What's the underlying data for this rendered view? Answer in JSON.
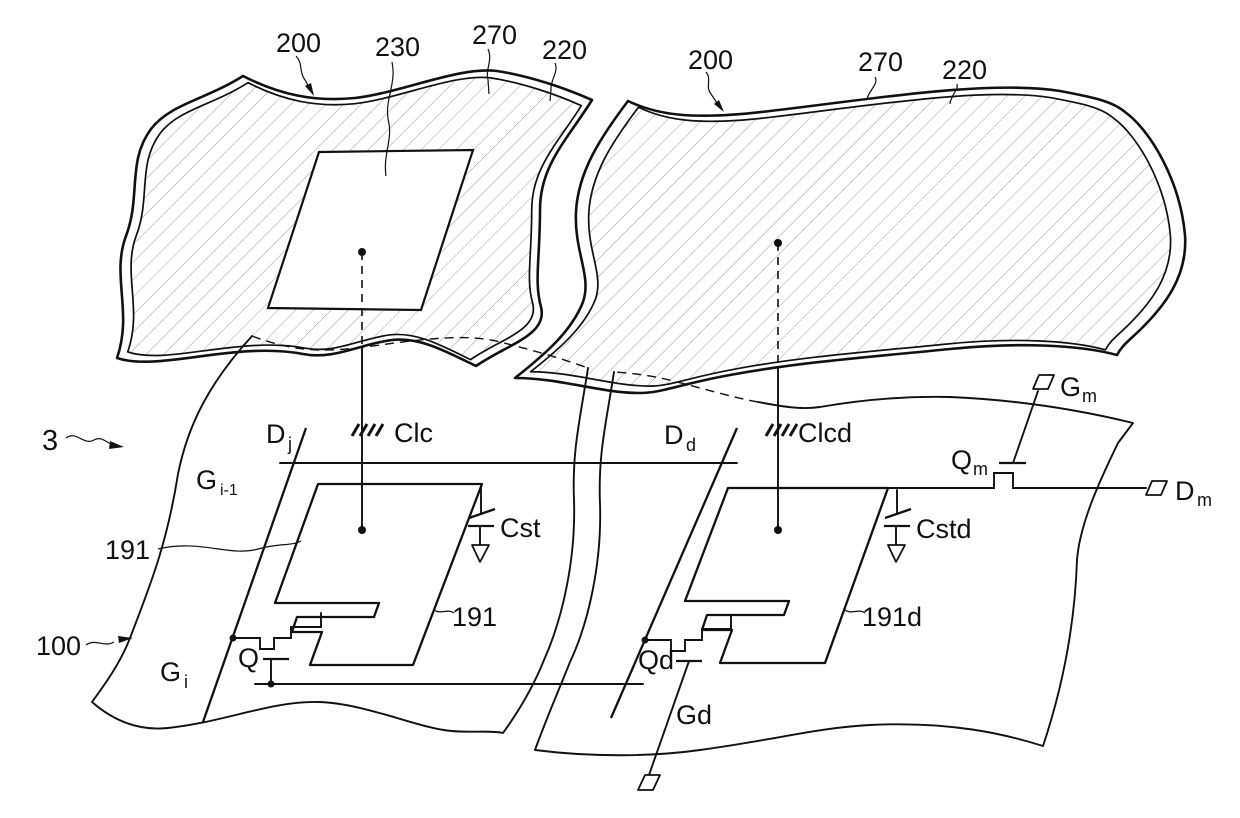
{
  "colors": {
    "line": "#111111",
    "hatch": "#9a9a9a",
    "background": "#ffffff"
  },
  "panels": {
    "left": {
      "panel": "200",
      "opening": "230",
      "common_electrode": "270",
      "substrate": "220"
    },
    "right": {
      "panel": "200",
      "common_electrode": "270",
      "substrate": "220"
    }
  },
  "lower": {
    "assembly": "3",
    "substrate": "100",
    "display_pixel": {
      "data_line": {
        "base": "D",
        "sub": "j"
      },
      "gate_line_prev": {
        "base": "G",
        "sub": "i-1"
      },
      "gate_line": {
        "base": "G",
        "sub": "i"
      },
      "clc": "Clc",
      "cst": "Cst",
      "tft": "Q",
      "electrode": "191",
      "electrode_callout": "191"
    },
    "dummy_pixel": {
      "data_line": {
        "base": "D",
        "sub": "d"
      },
      "clcd": "Clcd",
      "cstd": "Cstd",
      "tft": "Qd",
      "gate_lead": "Gd",
      "electrode": "191d"
    },
    "monitor": {
      "gate_pad": {
        "base": "G",
        "sub": "m"
      },
      "tft": {
        "base": "Q",
        "sub": "m"
      },
      "data_pad": {
        "base": "D",
        "sub": "m"
      }
    }
  }
}
